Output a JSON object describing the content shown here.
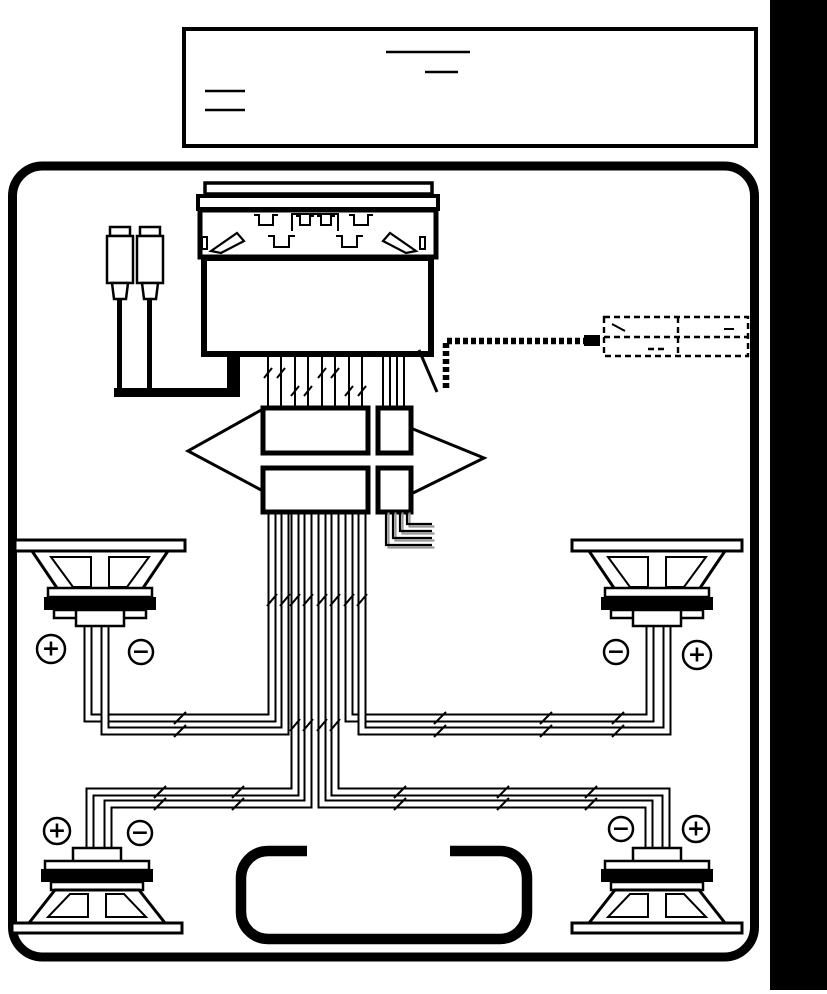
{
  "colors": {
    "ink": "#000000",
    "paper": "#ffffff",
    "wire_shadow": "#999999"
  },
  "note_box": {
    "blank_line_count": 4
  },
  "speakers": {
    "front_left": {
      "position": "top-left",
      "left_terminal": "+",
      "right_terminal": "−"
    },
    "front_right": {
      "position": "top-right",
      "left_terminal": "−",
      "right_terminal": "+"
    },
    "rear_left": {
      "position": "bottom-left",
      "left_terminal": "+",
      "right_terminal": "−"
    },
    "rear_right": {
      "position": "bottom-right",
      "left_terminal": "−",
      "right_terminal": "+"
    }
  }
}
